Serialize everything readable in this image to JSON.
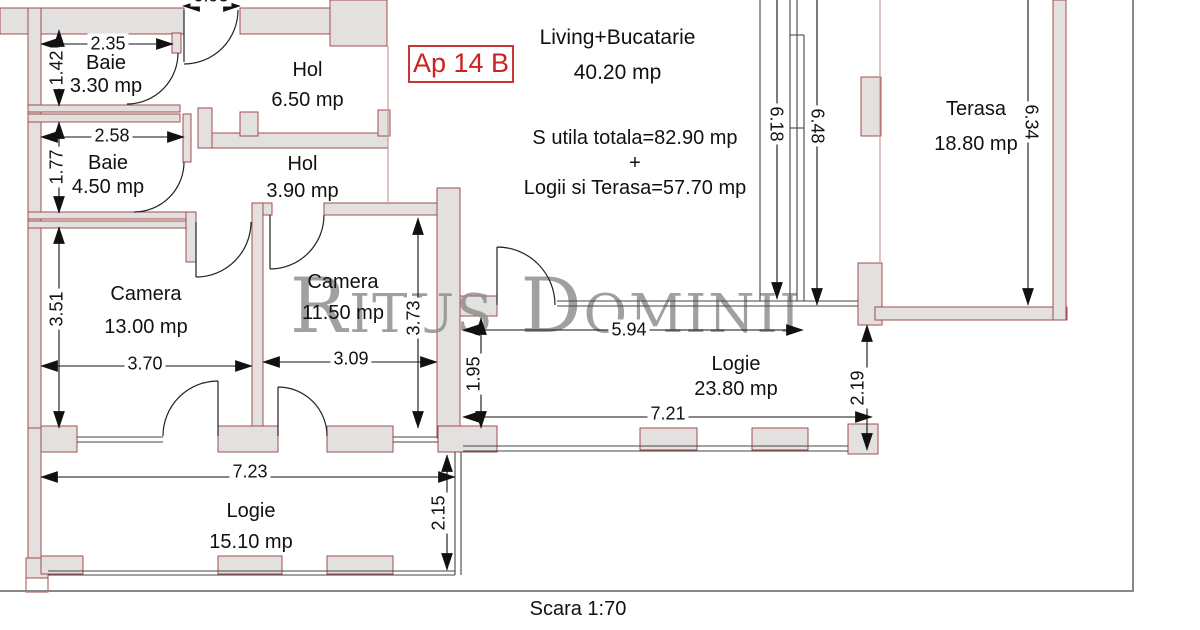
{
  "watermark": "Ritus Dominii",
  "plan": {
    "apartment_label": "Ap 14 B",
    "scale_label": "Scara 1:70",
    "summary": {
      "line1": "S utila totala=82.90 mp",
      "plus": "+",
      "line2": "Logii si Terasa=57.70 mp"
    }
  },
  "rooms": {
    "baie1": {
      "name": "Baie",
      "area": "3.30 mp"
    },
    "baie2": {
      "name": "Baie",
      "area": "4.50 mp"
    },
    "hol1": {
      "name": "Hol",
      "area": "6.50 mp"
    },
    "hol2": {
      "name": "Hol",
      "area": "3.90 mp"
    },
    "living": {
      "name": "Living+Bucatarie",
      "area": "40.20 mp"
    },
    "camera1": {
      "name": "Camera",
      "area": "13.00 mp"
    },
    "camera2": {
      "name": "Camera",
      "area": "11.50 mp"
    },
    "logie1": {
      "name": "Logie",
      "area": "23.80 mp"
    },
    "logie2": {
      "name": "Logie",
      "area": "15.10 mp"
    },
    "terasa": {
      "name": "Terasa",
      "area": "18.80 mp"
    }
  },
  "dims": {
    "d093": "0.93",
    "d235": "2.35",
    "d142": "1.42",
    "d258": "2.58",
    "d177": "1.77",
    "d351": "3.51",
    "d370": "3.70",
    "d309": "3.09",
    "d373": "3.73",
    "d594": "5.94",
    "d721": "7.21",
    "d195": "1.95",
    "d219": "2.19",
    "d723": "7.23",
    "d215": "2.15",
    "d618": "6.18",
    "d648": "6.48",
    "d634": "6.34"
  },
  "colors": {
    "accent_red": "#cc2222",
    "wall_outline": "#a24d4d",
    "wall_fill": "#e3e0e0",
    "watermark_grey": "#909090",
    "dimension_ink": "#111111",
    "frame_grey": "#888888"
  }
}
